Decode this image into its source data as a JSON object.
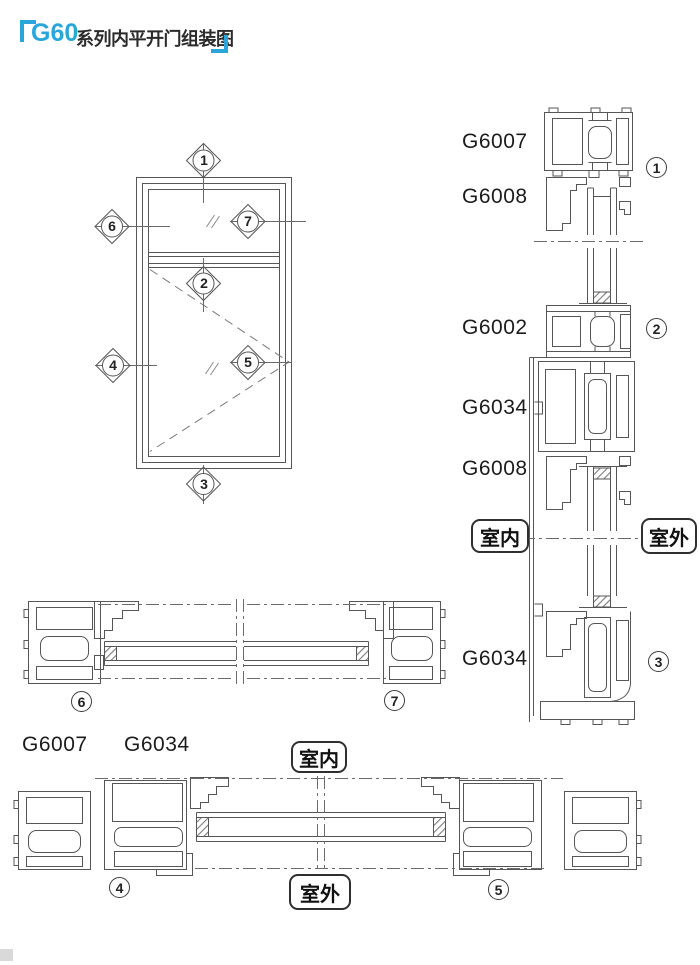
{
  "title": {
    "brand": "G60",
    "rest": "系列内平开门组装图"
  },
  "colors": {
    "accent": "#2ba6db",
    "line": "#565656",
    "text": "#1c1c1c"
  },
  "elevation": {
    "markers": [
      {
        "num": "1"
      },
      {
        "num": "2"
      },
      {
        "num": "3"
      },
      {
        "num": "4"
      },
      {
        "num": "5"
      },
      {
        "num": "6"
      },
      {
        "num": "7"
      }
    ]
  },
  "right_section": {
    "profile_labels": [
      {
        "text": "G6007"
      },
      {
        "text": "G6008"
      },
      {
        "text": "G6002"
      },
      {
        "text": "G6034"
      },
      {
        "text": "G6008"
      },
      {
        "text": "G6034"
      }
    ],
    "circled": [
      {
        "num": "1"
      },
      {
        "num": "2"
      },
      {
        "num": "3"
      }
    ],
    "indoor": "室内",
    "outdoor": "室外"
  },
  "bottom_sections": {
    "row1_circled": [
      {
        "num": "6"
      },
      {
        "num": "7"
      }
    ],
    "row2_labels": [
      {
        "text": "G6007"
      },
      {
        "text": "G6034"
      }
    ],
    "row2_circled": [
      {
        "num": "4"
      },
      {
        "num": "5"
      }
    ],
    "indoor": "室内",
    "outdoor": "室外"
  }
}
